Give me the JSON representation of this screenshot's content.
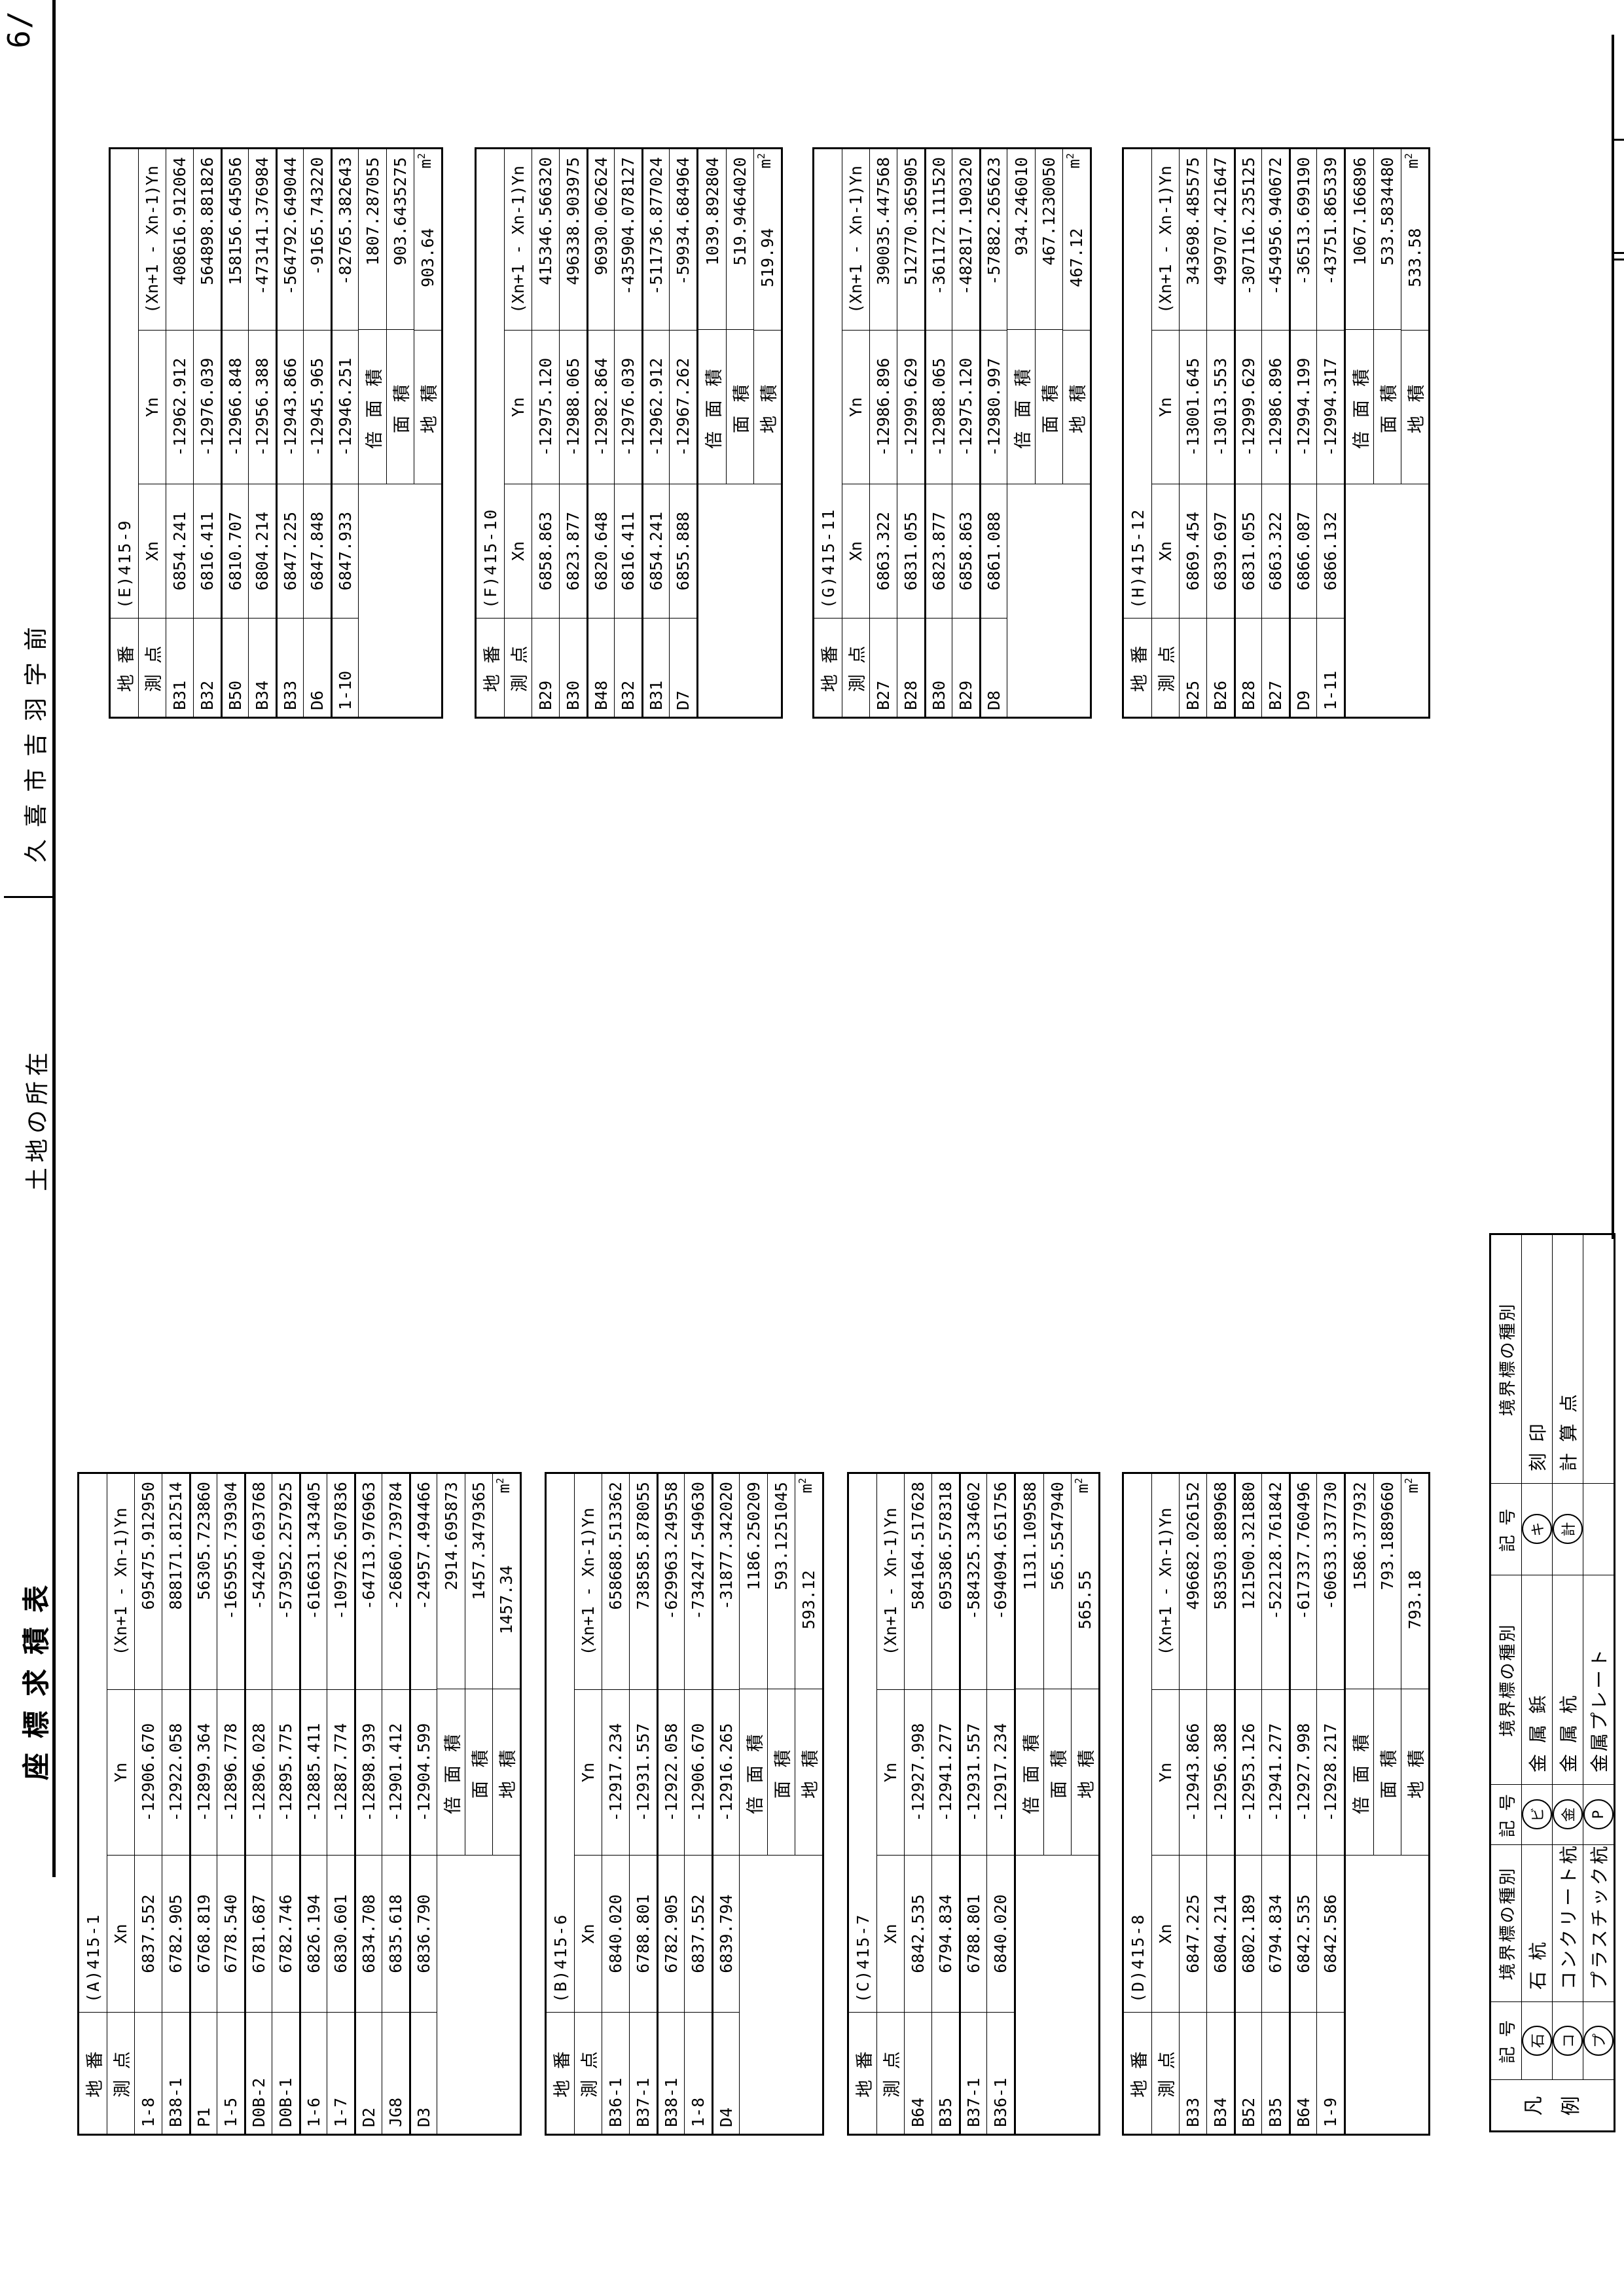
{
  "page": {
    "number_label": "6/",
    "title": "座標求積表",
    "location": {
      "label": "土地の所在",
      "value": "久喜市吉羽字前"
    }
  },
  "table_headers": {
    "parcel": "地 番",
    "station": "測 点",
    "x": "Xn",
    "y": "Yn",
    "product": "(Xn+1 - Xn-1)Yn",
    "double_area": "倍 面 積",
    "area": "面 積",
    "parcel_area": "地 積",
    "unit_base": "m",
    "unit_sup": "2"
  },
  "tables": [
    {
      "key": "A",
      "side": "left",
      "label": "(A)415-1",
      "points": [
        {
          "name": "1-8",
          "x": "6837.552",
          "y": "-12906.670",
          "p": "695475.912950"
        },
        {
          "name": "B38-1",
          "x": "6782.905",
          "y": "-12922.058",
          "p": "888171.812514"
        },
        {
          "name": "P1",
          "x": "6768.819",
          "y": "-12899.364",
          "p": "56305.723860"
        },
        {
          "name": "1-5",
          "x": "6778.540",
          "y": "-12896.778",
          "p": "-165955.739304"
        },
        {
          "name": "D0B-2",
          "x": "6781.687",
          "y": "-12896.028",
          "p": "-54240.693768"
        },
        {
          "name": "D0B-1",
          "x": "6782.746",
          "y": "-12895.775",
          "p": "-573952.257925"
        },
        {
          "name": "1-6",
          "x": "6826.194",
          "y": "-12885.411",
          "p": "-616631.343405"
        },
        {
          "name": "1-7",
          "x": "6830.601",
          "y": "-12887.774",
          "p": "-109726.507836"
        },
        {
          "name": "D2",
          "x": "6834.708",
          "y": "-12898.939",
          "p": "-64713.976963"
        },
        {
          "name": "JG8",
          "x": "6835.618",
          "y": "-12901.412",
          "p": "-26860.739784"
        },
        {
          "name": "D3",
          "x": "6836.790",
          "y": "-12904.599",
          "p": "-24957.494466"
        }
      ],
      "double_area": "2914.695873",
      "area": "1457.3479365",
      "parcel_area": "1457.34"
    },
    {
      "key": "B",
      "side": "left",
      "label": "(B)415-6",
      "points": [
        {
          "name": "B36-1",
          "x": "6840.020",
          "y": "-12917.234",
          "p": "658688.513362"
        },
        {
          "name": "B37-1",
          "x": "6788.801",
          "y": "-12931.557",
          "p": "738585.878055"
        },
        {
          "name": "B38-1",
          "x": "6782.905",
          "y": "-12922.058",
          "p": "-629963.249558"
        },
        {
          "name": "1-8",
          "x": "6837.552",
          "y": "-12906.670",
          "p": "-734247.549630"
        },
        {
          "name": "D4",
          "x": "6839.794",
          "y": "-12916.265",
          "p": "-31877.342020"
        }
      ],
      "double_area": "1186.250209",
      "area": "593.1251045",
      "parcel_area": "593.12"
    },
    {
      "key": "C",
      "side": "left",
      "label": "(C)415-7",
      "points": [
        {
          "name": "B64",
          "x": "6842.535",
          "y": "-12927.998",
          "p": "584164.517628"
        },
        {
          "name": "B35",
          "x": "6794.834",
          "y": "-12941.277",
          "p": "695386.578318"
        },
        {
          "name": "B37-1",
          "x": "6788.801",
          "y": "-12931.557",
          "p": "-584325.334602"
        },
        {
          "name": "B36-1",
          "x": "6840.020",
          "y": "-12917.234",
          "p": "-694094.651756"
        }
      ],
      "double_area": "1131.109588",
      "area": "565.5547940",
      "parcel_area": "565.55"
    },
    {
      "key": "D",
      "side": "left",
      "label": "(D)415-8",
      "points": [
        {
          "name": "B33",
          "x": "6847.225",
          "y": "-12943.866",
          "p": "496682.026152"
        },
        {
          "name": "B34",
          "x": "6804.214",
          "y": "-12956.388",
          "p": "583503.889968"
        },
        {
          "name": "B52",
          "x": "6802.189",
          "y": "-12953.126",
          "p": "121500.321880"
        },
        {
          "name": "B35",
          "x": "6794.834",
          "y": "-12941.277",
          "p": "-522128.761842"
        },
        {
          "name": "B64",
          "x": "6842.535",
          "y": "-12927.998",
          "p": "-617337.760496"
        },
        {
          "name": "1-9",
          "x": "6842.586",
          "y": "-12928.217",
          "p": "-60633.337730"
        }
      ],
      "double_area": "1586.377932",
      "area": "793.1889660",
      "parcel_area": "793.18"
    },
    {
      "key": "E",
      "side": "right",
      "label": "(E)415-9",
      "points": [
        {
          "name": "B31",
          "x": "6854.241",
          "y": "-12962.912",
          "p": "408616.912064"
        },
        {
          "name": "B32",
          "x": "6816.411",
          "y": "-12976.039",
          "p": "564898.881826"
        },
        {
          "name": "B50",
          "x": "6810.707",
          "y": "-12966.848",
          "p": "158156.645056"
        },
        {
          "name": "B34",
          "x": "6804.214",
          "y": "-12956.388",
          "p": "-473141.376984"
        },
        {
          "name": "B33",
          "x": "6847.225",
          "y": "-12943.866",
          "p": "-564792.649044"
        },
        {
          "name": "D6",
          "x": "6847.848",
          "y": "-12945.965",
          "p": "-9165.743220"
        },
        {
          "name": "1-10",
          "x": "6847.933",
          "y": "-12946.251",
          "p": "-82765.382643"
        }
      ],
      "double_area": "1807.287055",
      "area": "903.6435275",
      "parcel_area": "903.64"
    },
    {
      "key": "F",
      "side": "right",
      "label": "(F)415-10",
      "points": [
        {
          "name": "B29",
          "x": "6858.863",
          "y": "-12975.120",
          "p": "415346.566320"
        },
        {
          "name": "B30",
          "x": "6823.877",
          "y": "-12988.065",
          "p": "496338.903975"
        },
        {
          "name": "B48",
          "x": "6820.648",
          "y": "-12982.864",
          "p": "96930.062624"
        },
        {
          "name": "B32",
          "x": "6816.411",
          "y": "-12976.039",
          "p": "-435904.078127"
        },
        {
          "name": "B31",
          "x": "6854.241",
          "y": "-12962.912",
          "p": "-511736.877024"
        },
        {
          "name": "D7",
          "x": "6855.888",
          "y": "-12967.262",
          "p": "-59934.684964"
        }
      ],
      "double_area": "1039.892804",
      "area": "519.9464020",
      "parcel_area": "519.94"
    },
    {
      "key": "G",
      "side": "right",
      "label": "(G)415-11",
      "points": [
        {
          "name": "B27",
          "x": "6863.322",
          "y": "-12986.896",
          "p": "390035.447568"
        },
        {
          "name": "B28",
          "x": "6831.055",
          "y": "-12999.629",
          "p": "512770.365905"
        },
        {
          "name": "B30",
          "x": "6823.877",
          "y": "-12988.065",
          "p": "-361172.111520"
        },
        {
          "name": "B29",
          "x": "6858.863",
          "y": "-12975.120",
          "p": "-482817.190320"
        },
        {
          "name": "D8",
          "x": "6861.088",
          "y": "-12980.997",
          "p": "-57882.265623"
        }
      ],
      "double_area": "934.246010",
      "area": "467.1230050",
      "parcel_area": "467.12"
    },
    {
      "key": "H",
      "side": "right",
      "label": "(H)415-12",
      "points": [
        {
          "name": "B25",
          "x": "6869.454",
          "y": "-13001.645",
          "p": "343698.485575"
        },
        {
          "name": "B26",
          "x": "6839.697",
          "y": "-13013.553",
          "p": "499707.421647"
        },
        {
          "name": "B28",
          "x": "6831.055",
          "y": "-12999.629",
          "p": "-307116.235125"
        },
        {
          "name": "B27",
          "x": "6863.322",
          "y": "-12986.896",
          "p": "-454956.940672"
        },
        {
          "name": "D9",
          "x": "6866.087",
          "y": "-12994.199",
          "p": "-36513.699190"
        },
        {
          "name": "1-11",
          "x": "6866.132",
          "y": "-12994.317",
          "p": "-43751.865339"
        }
      ],
      "double_area": "1067.166896",
      "area": "533.5834480",
      "parcel_area": "533.58"
    }
  ],
  "legend": {
    "label": "凡例",
    "symbol_header": "記 号",
    "type_header": "境界標の種別",
    "pairs": [
      {
        "rows": [
          {
            "sym": "石",
            "text": "石 杭"
          },
          {
            "sym": "コ",
            "text": "コンクリート杭"
          },
          {
            "sym": "プ",
            "text": "プラスチック杭"
          }
        ]
      },
      {
        "rows": [
          {
            "sym": "ビ",
            "text": "金 属 鋲"
          },
          {
            "sym": "金",
            "text": "金 属 杭"
          },
          {
            "sym": "P",
            "text": "金属プレート"
          }
        ]
      },
      {
        "rows": [
          {
            "sym": "キ",
            "text": "刻 印"
          },
          {
            "sym": "計",
            "text": "計 算 点"
          },
          {
            "sym": "",
            "text": ""
          }
        ]
      }
    ]
  }
}
